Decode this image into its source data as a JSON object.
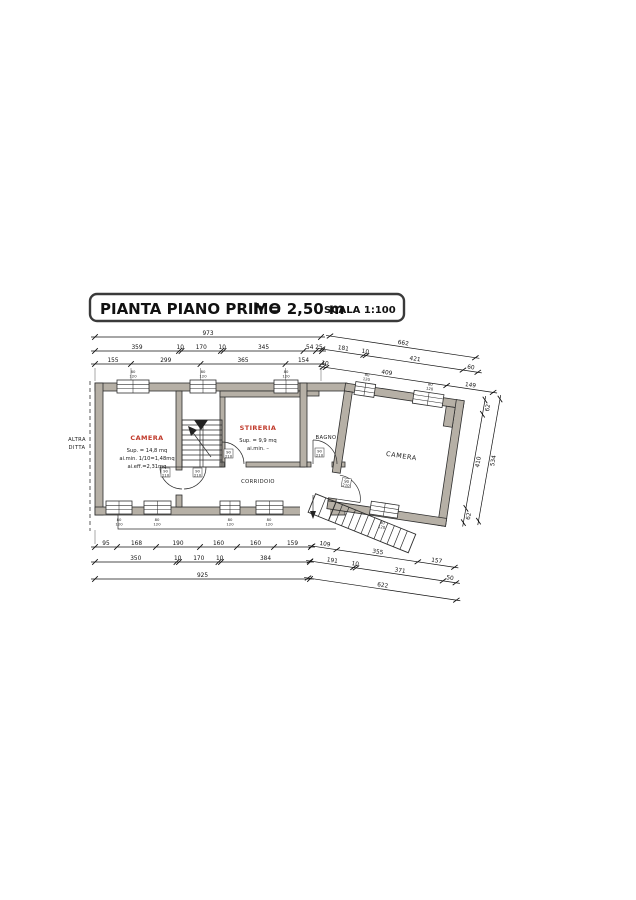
{
  "title": {
    "main": "PIANTA PIANO PRIMO",
    "height_note": "h = 2,50 m",
    "scale": "SCALA 1:100"
  },
  "rooms": {
    "camera1": {
      "name": "CAMERA",
      "sup": "Sup. = 14,8 mq",
      "ai_min": "ai.min. 1/10=1,48mq",
      "ai_eff": "ai.eff.=2,31mq"
    },
    "stireria": {
      "name": "STIRERIA",
      "sup": "Sup. = 9,9 mq",
      "ai_min": "ai.min. –"
    },
    "bagno": {
      "name": "BAGNO"
    },
    "camera2": {
      "name": "CAMERA"
    },
    "corridoio": {
      "name": "CORRIDOIO"
    }
  },
  "annotations": {
    "altra_line1": "ALTRA",
    "altra_line2": "DITTA"
  },
  "tags": {
    "window_top": "80",
    "window_bottom": "120",
    "door_top": "90",
    "door_bottom": "210"
  },
  "colors": {
    "wall_fill": "#b6b0a6",
    "line": "#2e2e2e",
    "room_label_red": "#c03a2b"
  },
  "dimensions": {
    "chains": [
      {
        "name": "top-total",
        "x": 95,
        "y": 337,
        "angle": 0,
        "segs": [
          {
            "len": 226,
            "label": "973"
          }
        ]
      },
      {
        "name": "top-row2",
        "x": 95,
        "y": 351,
        "angle": 0,
        "segs": [
          {
            "len": 84,
            "label": "359"
          },
          {
            "len": 2.5,
            "label": "10"
          },
          {
            "len": 39.5,
            "label": "170"
          },
          {
            "len": 2.5,
            "label": "10"
          },
          {
            "len": 80,
            "label": "345"
          },
          {
            "len": 12.5,
            "label": "54"
          },
          {
            "len": 6,
            "label": "25"
          }
        ]
      },
      {
        "name": "top-row3",
        "x": 95,
        "y": 364,
        "angle": 0,
        "segs": [
          {
            "len": 36,
            "label": "155"
          },
          {
            "len": 69.5,
            "label": "299"
          },
          {
            "len": 85,
            "label": "365"
          },
          {
            "len": 36,
            "label": "154"
          }
        ]
      },
      {
        "name": "top-slope-total",
        "x": 330,
        "y": 336,
        "angle": 8.5,
        "segs": [
          {
            "len": 147,
            "label": "662"
          }
        ]
      },
      {
        "name": "top-slope-row2",
        "x": 322,
        "y": 349,
        "angle": 8.5,
        "segs": [
          {
            "len": 42,
            "label": "181"
          },
          {
            "len": 2.5,
            "label": "10"
          },
          {
            "len": 98,
            "label": "421"
          },
          {
            "len": 15,
            "label": "60"
          }
        ]
      },
      {
        "name": "top-slope-row3",
        "x": 323,
        "y": 367,
        "angle": 8.5,
        "segs": [
          {
            "len": 3,
            "label": "10"
          },
          {
            "len": 122,
            "label": "409"
          },
          {
            "len": 47,
            "label": "149"
          }
        ]
      },
      {
        "name": "bottom-row1",
        "x": 95,
        "y": 547,
        "angle": 0,
        "segs": [
          {
            "len": 22,
            "label": "95"
          },
          {
            "len": 39,
            "label": "168"
          },
          {
            "len": 44,
            "label": "190"
          },
          {
            "len": 37,
            "label": "160"
          },
          {
            "len": 37,
            "label": "160"
          },
          {
            "len": 37,
            "label": "159"
          }
        ]
      },
      {
        "name": "bottom-row2",
        "x": 95,
        "y": 562,
        "angle": 0,
        "segs": [
          {
            "len": 81.5,
            "label": "350"
          },
          {
            "len": 2.5,
            "label": "10"
          },
          {
            "len": 39.5,
            "label": "170"
          },
          {
            "len": 2.5,
            "label": "10"
          },
          {
            "len": 89,
            "label": "384"
          }
        ]
      },
      {
        "name": "bottom-total",
        "x": 95,
        "y": 579,
        "angle": 0,
        "segs": [
          {
            "len": 215,
            "label": "925"
          }
        ]
      },
      {
        "name": "bottom-slope-row1",
        "x": 312,
        "y": 546,
        "angle": 8.5,
        "segs": [
          {
            "len": 25,
            "label": "109"
          },
          {
            "len": 82,
            "label": "355"
          },
          {
            "len": 37,
            "label": "157"
          }
        ]
      },
      {
        "name": "bottom-slope-row2",
        "x": 310,
        "y": 561,
        "angle": 8.5,
        "segs": [
          {
            "len": 44,
            "label": "191"
          },
          {
            "len": 2.5,
            "label": "10"
          },
          {
            "len": 88,
            "label": "371"
          },
          {
            "len": 13,
            "label": "50"
          }
        ]
      },
      {
        "name": "bottom-slope-total",
        "x": 308,
        "y": 578,
        "angle": 8.5,
        "segs": [
          {
            "len": 150,
            "label": "622"
          }
        ]
      },
      {
        "name": "right-side-inner",
        "x": 485,
        "y": 400,
        "angle": 100,
        "flip": true,
        "segs": [
          {
            "len": 14.5,
            "label": "62"
          },
          {
            "len": 95.5,
            "label": "410"
          },
          {
            "len": 14.5,
            "label": "62"
          }
        ]
      },
      {
        "name": "right-side-total",
        "x": 500,
        "y": 399,
        "angle": 100,
        "flip": true,
        "segs": [
          {
            "len": 124,
            "label": "534"
          }
        ]
      }
    ]
  }
}
